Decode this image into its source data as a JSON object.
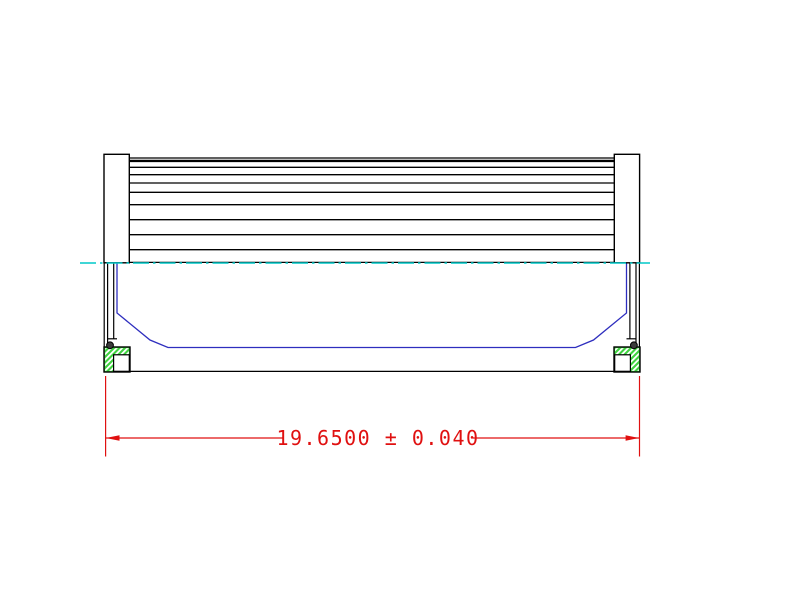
{
  "drawing": {
    "type": "technical-drawing",
    "subject": "filter-element-cross-section",
    "dimension": {
      "value": "19.6500",
      "tolerance": "± 0.040",
      "label": "19.6500 ± 0.040"
    },
    "colors": {
      "outline_black": "#000000",
      "perforation_blue": "#2e2ebe",
      "centerline_cyan": "#00c8c8",
      "gasket_green": "#3fd23f",
      "dimension_red": "#e01010",
      "oring_gray": "#3c3c3c",
      "background": "#ffffff"
    }
  }
}
